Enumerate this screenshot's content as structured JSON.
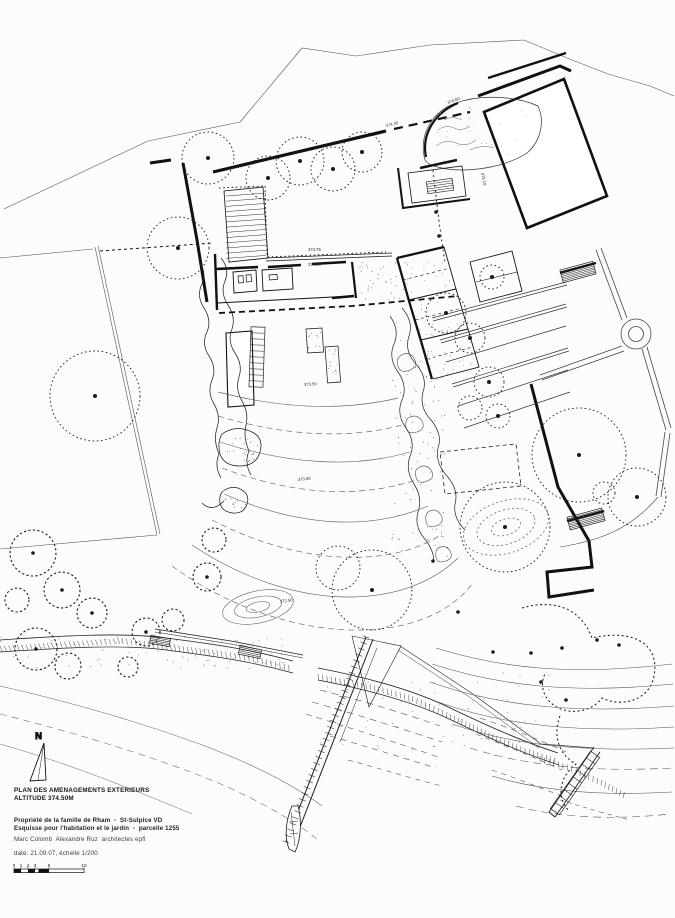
{
  "document": {
    "title_line1": "PLAN DES AMENAGEMENTS EXTERIEURS",
    "title_line2": "ALTITUDE 374.50M",
    "subtitle_line1": "Propriété de la famille de Rham  -  St-Sulpice VD",
    "subtitle_line2": "Esquisse pour l'habitation et le jardin  -  parcelle 1255",
    "architects": "Marc Colomb  Alexandre Ruz  architectes epfl",
    "date_scale": "date: 21.09.07, échelle 1/200",
    "north_label": "N"
  },
  "scale_bar": {
    "ticks": [
      "0",
      "1",
      "2",
      "3",
      "5",
      "10"
    ],
    "tick_values": [
      0,
      1,
      2,
      3,
      5,
      10
    ],
    "filled_segments": [
      [
        0,
        1
      ],
      [
        2,
        3
      ],
      [
        3.5,
        5
      ]
    ],
    "units_total": 10
  },
  "plan": {
    "ink": "#1b1b1b",
    "spot_elevations": [
      {
        "text": "374.75",
        "x": 308,
        "y": 251,
        "rot": 0
      },
      {
        "text": "374.50",
        "x": 308,
        "y": 266,
        "rot": 0
      },
      {
        "text": "373.50",
        "x": 304,
        "y": 386,
        "rot": -4
      },
      {
        "text": "373.00",
        "x": 298,
        "y": 481,
        "rot": -6
      },
      {
        "text": "372.50",
        "x": 280,
        "y": 603,
        "rot": -8
      },
      {
        "text": "374.45",
        "x": 386,
        "y": 127,
        "rot": -13
      },
      {
        "text": "374.60",
        "x": 448,
        "y": 104,
        "rot": -20
      },
      {
        "text": "375.10",
        "x": 481,
        "y": 173,
        "rot": 78
      }
    ],
    "trees": [
      {
        "x": 208,
        "y": 158,
        "r": 26,
        "dot": true
      },
      {
        "x": 178,
        "y": 248,
        "r": 31,
        "dot": true
      },
      {
        "x": 95,
        "y": 396,
        "r": 45,
        "dot": true
      },
      {
        "x": 268,
        "y": 178,
        "r": 22,
        "dot": true
      },
      {
        "x": 300,
        "y": 161,
        "r": 24,
        "dot": true
      },
      {
        "x": 333,
        "y": 169,
        "r": 22,
        "dot": true
      },
      {
        "x": 362,
        "y": 152,
        "r": 20,
        "dot": true
      },
      {
        "x": 446,
        "y": 313,
        "r": 20,
        "dot": true
      },
      {
        "x": 470,
        "y": 338,
        "r": 15,
        "dot": true
      },
      {
        "x": 489,
        "y": 382,
        "r": 15,
        "dot": true
      },
      {
        "x": 470,
        "y": 408,
        "r": 12,
        "dot": false
      },
      {
        "x": 498,
        "y": 416,
        "r": 12,
        "dot": true
      },
      {
        "x": 492,
        "y": 277,
        "r": 12,
        "dot": true
      },
      {
        "x": 579,
        "y": 455,
        "r": 47,
        "dot": true
      },
      {
        "x": 637,
        "y": 497,
        "r": 29,
        "dot": true
      },
      {
        "x": 604,
        "y": 493,
        "r": 11,
        "dot": false
      },
      {
        "x": 372,
        "y": 590,
        "r": 40,
        "dot": true
      },
      {
        "x": 338,
        "y": 568,
        "r": 22,
        "dot": false
      },
      {
        "x": 505,
        "y": 527,
        "r": 45,
        "dot": true
      }
    ],
    "bushes": [
      {
        "x": 33,
        "y": 553,
        "r": 23,
        "dot": true
      },
      {
        "x": 62,
        "y": 590,
        "r": 18,
        "dot": true
      },
      {
        "x": 92,
        "y": 613,
        "r": 15,
        "dot": true
      },
      {
        "x": 36,
        "y": 649,
        "r": 21,
        "dot": true
      },
      {
        "x": 68,
        "y": 666,
        "r": 13,
        "dot": false
      },
      {
        "x": 146,
        "y": 632,
        "r": 14,
        "dot": true
      },
      {
        "x": 173,
        "y": 620,
        "r": 11,
        "dot": false
      },
      {
        "x": 207,
        "y": 577,
        "r": 14,
        "dot": true
      },
      {
        "x": 128,
        "y": 667,
        "r": 10,
        "dot": false
      },
      {
        "x": 17,
        "y": 600,
        "r": 12,
        "dot": false
      },
      {
        "x": 214,
        "y": 540,
        "r": 12,
        "dot": false
      }
    ],
    "trunk_dots": [
      [
        433,
        561
      ],
      [
        493,
        652
      ],
      [
        531,
        653
      ],
      [
        541,
        682
      ],
      [
        562,
        648
      ],
      [
        458,
        612
      ],
      [
        619,
        645
      ],
      [
        566,
        700
      ],
      [
        597,
        640
      ],
      [
        436,
        212
      ],
      [
        439,
        236
      ]
    ]
  }
}
